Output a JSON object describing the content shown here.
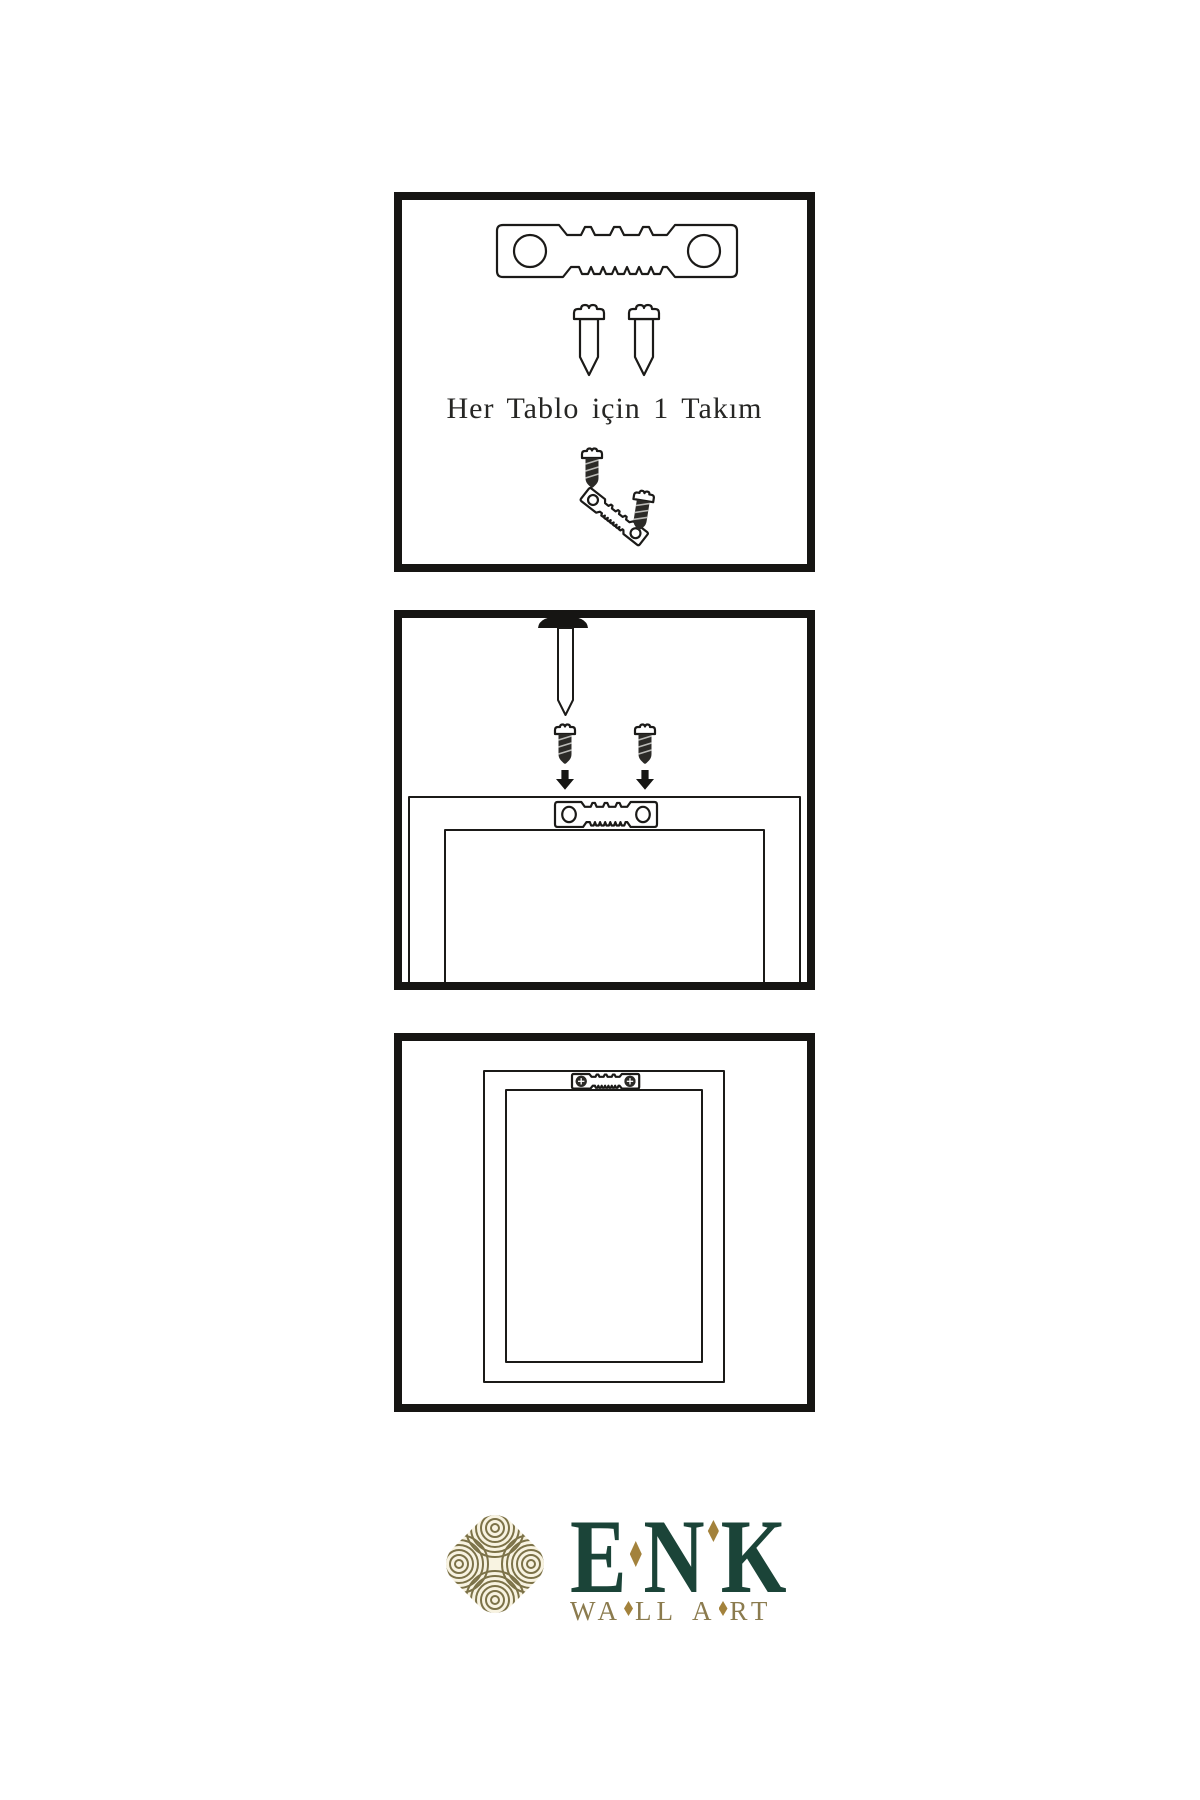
{
  "page": {
    "background": "#ffffff"
  },
  "step1": {
    "caption": "Her Tablo için 1 Takım"
  },
  "steps": {
    "step1_name": "hardware-kit: sawtooth hanger and two screws per frame",
    "step2_name": "mount hanger on frame back, nail in wall",
    "step3_name": "frame hung on wall"
  },
  "icons": [
    "sawtooth-hanger-icon",
    "screw-icon",
    "nail-icon",
    "arrow-down-icon",
    "frame-back-icon",
    "hung-frame-icon",
    "knot-logo-icon",
    "diamond-icon"
  ],
  "logo": {
    "brand_letters": [
      "E",
      "N",
      "K"
    ],
    "tagline_parts": [
      "WA",
      "LL",
      "A",
      "RT"
    ]
  },
  "colors": {
    "line": "#1b1a18",
    "brand_green": "#1b4438",
    "diamond_gold": "#a3823c",
    "tagline_gold": "#8b7b4e",
    "knot_olive": "#7c7248",
    "knot_cream": "#f8f3e1"
  }
}
